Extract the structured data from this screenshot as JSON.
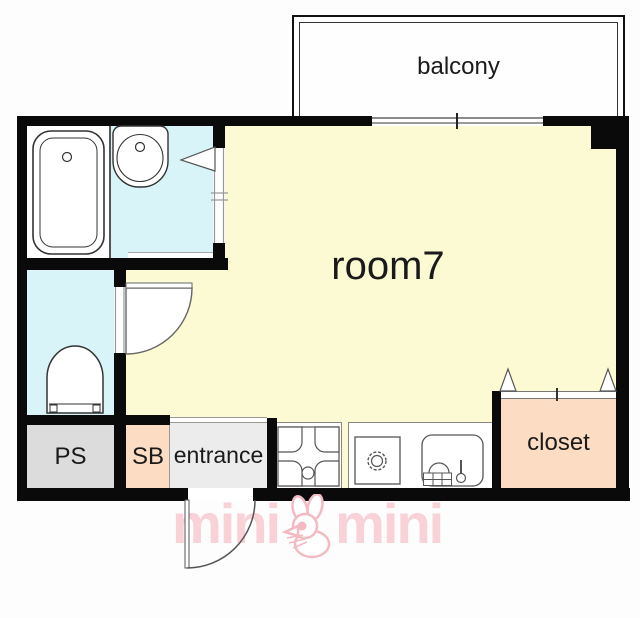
{
  "floorplan": {
    "rooms": {
      "balcony": {
        "label": "balcony"
      },
      "main": {
        "label": "room7"
      },
      "ps": {
        "label": "PS"
      },
      "sb": {
        "label": "SB"
      },
      "entrance": {
        "label": "entrance"
      },
      "closet": {
        "label": "closet"
      }
    },
    "fixtures": [
      "bathtub",
      "washbasin",
      "toilet",
      "washer-pan",
      "stove",
      "kitchen-sink"
    ],
    "doors": [
      "washroom-sliding-door",
      "toilet-swing-door",
      "entrance-swing-door",
      "closet-sliding-door",
      "balcony-sliding-window"
    ],
    "colors": {
      "room_yellow": "#fcfad2",
      "wet_area_cyan": "#d8f4f8",
      "closet_peach": "#fcdcc2",
      "ps_gray": "#dcdcdc",
      "entrance_gray": "#ececec",
      "wall_black": "#0a0a0a",
      "logo_pink": "#f8d2d7"
    },
    "logo": {
      "word_left": "mini",
      "word_right": "mini",
      "mascot": "rabbit"
    }
  }
}
